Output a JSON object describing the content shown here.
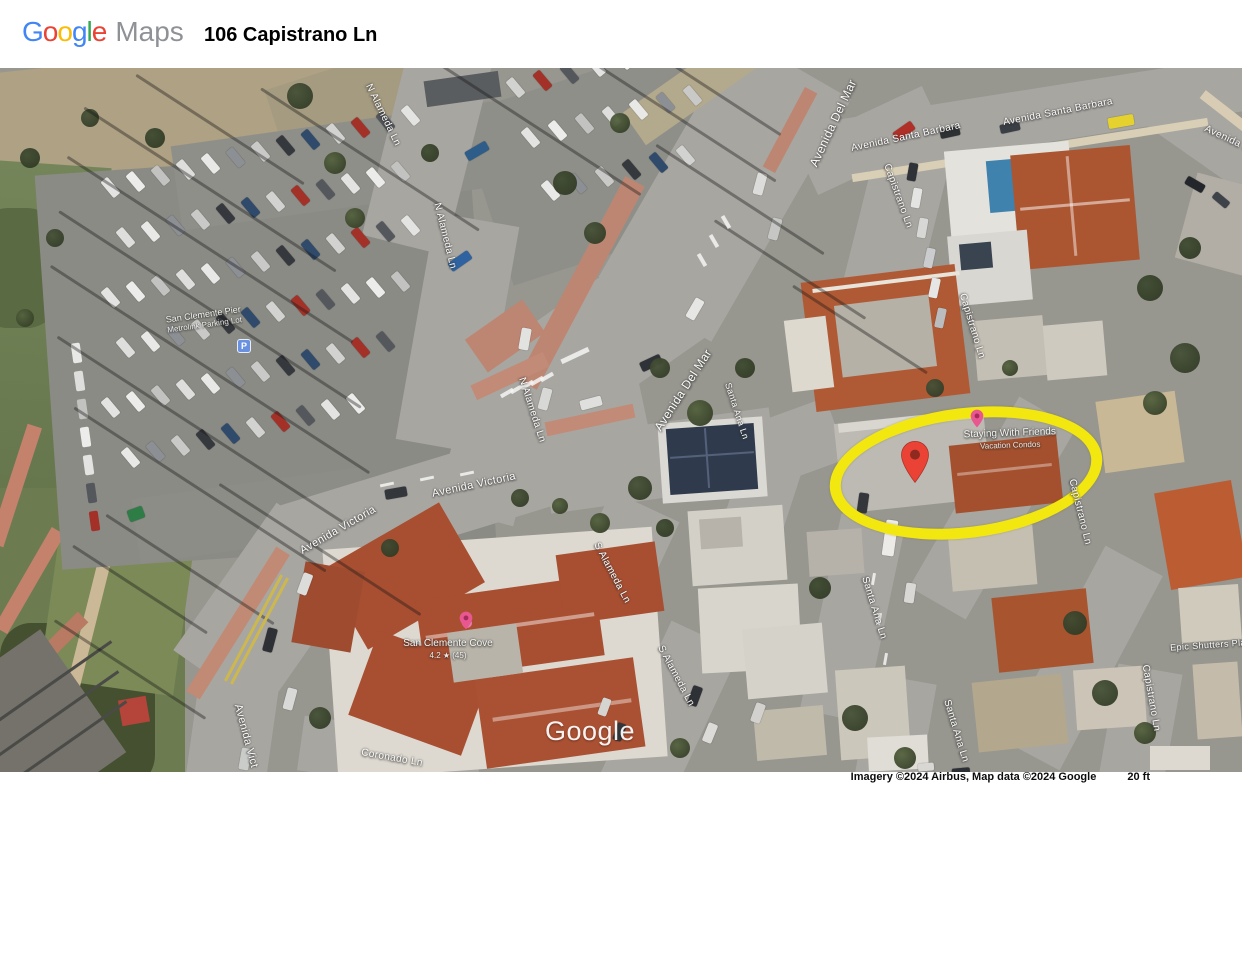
{
  "header": {
    "logo_word": "Google",
    "logo_letter_colors": [
      "#4285F4",
      "#EA4335",
      "#FBBC05",
      "#4285F4",
      "#34A853",
      "#EA4335"
    ],
    "logo_suffix": "Maps",
    "address": "106 Capistrano Ln"
  },
  "map": {
    "watermark": "Google",
    "attribution": "Imagery ©2024 Airbus, Map data ©2024 Google",
    "scale_text": "20 ft",
    "highlight": {
      "x": 955,
      "y": 394,
      "w": 252,
      "h": 108,
      "rot": -7,
      "color": "#f2e70e",
      "thickness": 11
    },
    "pin": {
      "x": 915,
      "y": 396,
      "color": "#EA4335",
      "dot_color": "#8f2a20"
    },
    "street_labels": [
      {
        "text": "N Alameda Ln",
        "x": 383,
        "y": 47,
        "rot": 64,
        "fs": 10
      },
      {
        "text": "N Alameda Ln",
        "x": 445,
        "y": 168,
        "rot": 76,
        "fs": 10
      },
      {
        "text": "N Alameda Ln",
        "x": 532,
        "y": 342,
        "rot": 72,
        "fs": 10
      },
      {
        "text": "Avenida Del Mar",
        "x": 833,
        "y": 55,
        "rot": -65,
        "fs": 12
      },
      {
        "text": "Avenida Del Mar",
        "x": 683,
        "y": 322,
        "rot": -57,
        "fs": 12
      },
      {
        "text": "Avenida Santa Barbara",
        "x": 906,
        "y": 69,
        "rot": -12,
        "fs": 10
      },
      {
        "text": "Avenida Santa Barbara",
        "x": 1058,
        "y": 44,
        "rot": -11,
        "fs": 10
      },
      {
        "text": "Avenida Sa",
        "x": 1230,
        "y": 72,
        "rot": 25,
        "fs": 10
      },
      {
        "text": "Capistrano Ln",
        "x": 898,
        "y": 128,
        "rot": 70,
        "fs": 10
      },
      {
        "text": "Capistrano Ln",
        "x": 972,
        "y": 258,
        "rot": 73,
        "fs": 10
      },
      {
        "text": "Capistrano Ln",
        "x": 1080,
        "y": 444,
        "rot": 76,
        "fs": 10
      },
      {
        "text": "Capistrano Ln",
        "x": 1151,
        "y": 630,
        "rot": 80,
        "fs": 10
      },
      {
        "text": "Santa Ana Ln",
        "x": 737,
        "y": 343,
        "rot": 72,
        "fs": 9
      },
      {
        "text": "Santa Ana Ln",
        "x": 874,
        "y": 540,
        "rot": 73,
        "fs": 10
      },
      {
        "text": "Santa Ana Ln",
        "x": 956,
        "y": 663,
        "rot": 73,
        "fs": 10
      },
      {
        "text": "S Alameda Ln",
        "x": 612,
        "y": 505,
        "rot": 62,
        "fs": 10
      },
      {
        "text": "S Alameda Ln",
        "x": 676,
        "y": 608,
        "rot": 62,
        "fs": 10
      },
      {
        "text": "Avenida Victoria",
        "x": 474,
        "y": 417,
        "rot": -12,
        "fs": 11
      },
      {
        "text": "Avenida Victoria",
        "x": 338,
        "y": 462,
        "rot": -30,
        "fs": 11
      },
      {
        "text": "Avenida Vict",
        "x": 246,
        "y": 668,
        "rot": 75,
        "fs": 11
      },
      {
        "text": "Coronado Ln",
        "x": 392,
        "y": 690,
        "rot": 10,
        "fs": 10
      },
      {
        "text": "Epic Shutters Pla",
        "x": 1208,
        "y": 577,
        "rot": -4,
        "fs": 9
      }
    ],
    "poi_labels": [
      {
        "lines": [
          "San Clemente Pier",
          "Metrolink Parking Lot"
        ],
        "x": 204,
        "y": 252,
        "rot": -8,
        "fs": 9,
        "icon": "parking",
        "icon_x": 237,
        "icon_y": 271
      },
      {
        "lines": [
          "Staying With Friends",
          "Vacation Condos"
        ],
        "x": 1010,
        "y": 371,
        "rot": -2,
        "fs": 10,
        "icon": "poi",
        "icon_x": 977,
        "icon_y": 350
      },
      {
        "lines": [
          "San Clemente Cove",
          "4.2 ★ (45)"
        ],
        "x": 448,
        "y": 581,
        "rot": 0,
        "fs": 10,
        "icon": "poi",
        "icon_x": 466,
        "icon_y": 552
      }
    ]
  }
}
